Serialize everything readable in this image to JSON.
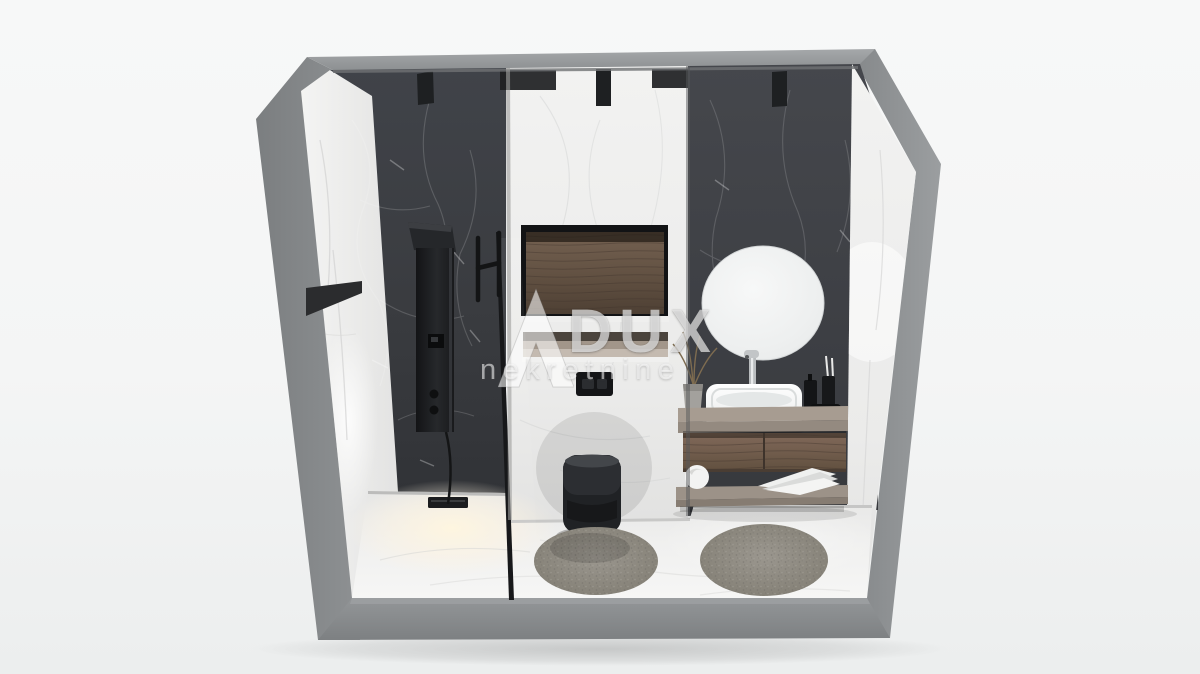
{
  "meta": {
    "title": "3D cutaway rendering of a modern bathroom",
    "style": "black and white marble bathroom visualization",
    "background_color": "#f5f6f6"
  },
  "watermark": {
    "brand": "DUX",
    "subtitle": "nekretnine",
    "logo": "dux-triangle-logo",
    "color": "rgba(255,255,255,0.6)"
  },
  "palette": {
    "shell_gray": "#8b8e90",
    "dark_marble": "#3c3e42",
    "light_marble": "#ededec",
    "wood": "#6e5b4d",
    "countertop_taupe": "#a0968c",
    "fixture_black": "#1f2022",
    "chrome": "#c8cbcd",
    "rug_gray": "#8e8b86",
    "floor_glow": "#fdf7e8"
  },
  "scene_elements": [
    "gray cutaway shell walls and base",
    "white marble side walls",
    "dark marble shower wall with black shower panel column",
    "glass shower partition with black handle",
    "linear black floor drain",
    "black corner shelf",
    "white marble toilet wall with wood inlay niche",
    "recessed storage niche",
    "black flush plate",
    "wall-hung matte black toilet",
    "dark marble vanity wall",
    "round frameless mirror",
    "white vessel sink with chrome faucet",
    "floating wood vanity with two drawers",
    "open lower shelf with towels",
    "dried plant in gray pot",
    "black toiletry bottles and tray",
    "two round gray shag rugs",
    "ceiling spotlights on wall tops"
  ]
}
